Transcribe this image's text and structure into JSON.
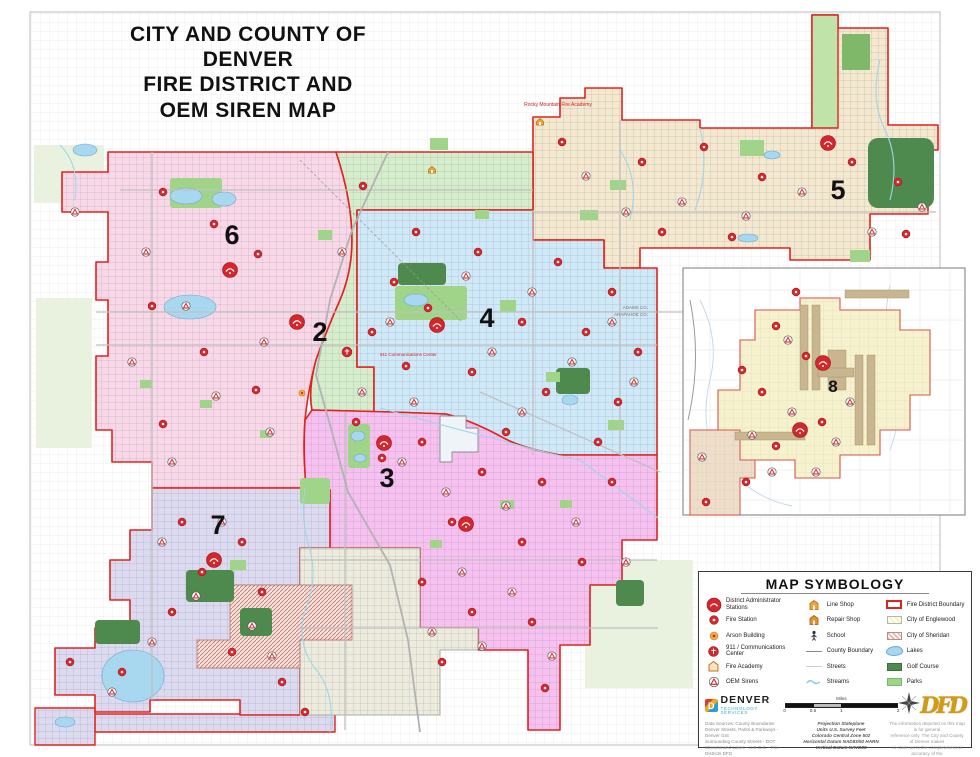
{
  "title": {
    "line1": "CITY AND COUNTY OF DENVER",
    "line2": "FIRE DISTRICT AND",
    "line3": "OEM SIREN MAP"
  },
  "districts": [
    {
      "number": "6",
      "color": "#f8d8e6"
    },
    {
      "number": "2",
      "color": "#d5edcb"
    },
    {
      "number": "4",
      "color": "#cfe9f7"
    },
    {
      "number": "5",
      "color": "#f4e8cf"
    },
    {
      "number": "3",
      "color": "#f6c0ef"
    },
    {
      "number": "7",
      "color": "#dcdaef"
    },
    {
      "number": "8",
      "color": "#f6f2cd"
    }
  ],
  "map_labels": {
    "fire_academy": "Rocky Mountain Fire Academy",
    "comm_center": "911 Communications Center",
    "county_north": "ADAMS CO.",
    "county_south": "ARAPAHOE CO."
  },
  "legend": {
    "title": "MAP SYMBOLOGY",
    "col1": [
      {
        "icon": "district-admin-station-icon",
        "label": "District Administrator Stations"
      },
      {
        "icon": "fire-station-icon",
        "label": "Fire Station"
      },
      {
        "icon": "arson-building-icon",
        "label": "Arson Building"
      },
      {
        "icon": "911-communications-icon",
        "label": "911 / Communications Center"
      },
      {
        "icon": "fire-academy-icon",
        "label": "Fire Academy"
      },
      {
        "icon": "oem-siren-icon",
        "label": "OEM Sirens"
      }
    ],
    "col2": [
      {
        "icon": "line-shop-icon",
        "label": "Line Shop"
      },
      {
        "icon": "repair-shop-icon",
        "label": "Repair Shop"
      },
      {
        "icon": "school-icon",
        "label": "School"
      },
      {
        "icon": "county-boundary-icon",
        "label": "County Boundary"
      },
      {
        "icon": "streets-icon",
        "label": "Streets"
      },
      {
        "icon": "streams-icon",
        "label": "Streams"
      }
    ],
    "col3": [
      {
        "icon": "fire-district-boundary-swatch",
        "label": "Fire District Boundary"
      },
      {
        "icon": "englewood-swatch",
        "label": "City of Englewood"
      },
      {
        "icon": "sheridan-swatch",
        "label": "City of Sheridan"
      },
      {
        "icon": "lakes-swatch",
        "label": "Lakes"
      },
      {
        "icon": "golf-course-swatch",
        "label": "Golf Course"
      },
      {
        "icon": "parks-swatch",
        "label": "Parks"
      }
    ]
  },
  "footer": {
    "denver_logo_title": "DENVER",
    "denver_logo_subtitle": "TECHNOLOGY SERVICES",
    "denver_logo_letter": "D",
    "dfd_logo": "DFD",
    "scale": {
      "unit": "Miles",
      "labels": [
        "0",
        "0.5",
        "1",
        "2"
      ]
    },
    "data_sources": [
      "Data Sources: County Boundaries",
      "Denver Streets, Parks & Parkways - Denver GIS",
      "Surrounding County Streets - DOT",
      "Streams and Lakes - U.S.G.S. - Fire Districts DFD"
    ],
    "projection": [
      "Projection Stateplane",
      "Units U.S. Survey Feet",
      "Colorado Central Zone 502",
      "Horizontal Datum NAD83/92 HARN",
      "Vertical Datum NAVD88"
    ],
    "disclaimer": [
      "The information depicted on this map is for general",
      "reference only. The City and County of Denver makes",
      "no claim as to the completeness or accuracy of the",
      "data contained hereon."
    ],
    "map_prepared": "Map Prepared: January 10, 2003"
  },
  "map": {
    "boundary_color": "#e0231f",
    "icons": {
      "district_admin": [
        [
          230,
          270
        ],
        [
          297,
          322
        ],
        [
          437,
          325
        ],
        [
          828,
          143
        ],
        [
          384,
          443
        ],
        [
          466,
          524
        ],
        [
          214,
          560
        ],
        [
          823,
          363
        ],
        [
          800,
          430
        ]
      ],
      "fire_station": [
        [
          163,
          192
        ],
        [
          214,
          224
        ],
        [
          258,
          254
        ],
        [
          152,
          306
        ],
        [
          204,
          352
        ],
        [
          256,
          390
        ],
        [
          163,
          424
        ],
        [
          363,
          186
        ],
        [
          416,
          232
        ],
        [
          394,
          282
        ],
        [
          428,
          308
        ],
        [
          372,
          332
        ],
        [
          406,
          366
        ],
        [
          356,
          422
        ],
        [
          382,
          458
        ],
        [
          478,
          252
        ],
        [
          558,
          262
        ],
        [
          612,
          292
        ],
        [
          522,
          322
        ],
        [
          586,
          332
        ],
        [
          638,
          352
        ],
        [
          472,
          372
        ],
        [
          546,
          392
        ],
        [
          618,
          402
        ],
        [
          506,
          432
        ],
        [
          598,
          442
        ],
        [
          562,
          142
        ],
        [
          642,
          162
        ],
        [
          704,
          147
        ],
        [
          762,
          177
        ],
        [
          852,
          162
        ],
        [
          898,
          182
        ],
        [
          662,
          232
        ],
        [
          732,
          237
        ],
        [
          906,
          234
        ],
        [
          422,
          442
        ],
        [
          482,
          472
        ],
        [
          542,
          482
        ],
        [
          612,
          482
        ],
        [
          452,
          522
        ],
        [
          522,
          542
        ],
        [
          582,
          562
        ],
        [
          422,
          582
        ],
        [
          472,
          612
        ],
        [
          532,
          622
        ],
        [
          442,
          662
        ],
        [
          545,
          688
        ],
        [
          182,
          522
        ],
        [
          242,
          542
        ],
        [
          202,
          572
        ],
        [
          262,
          592
        ],
        [
          172,
          612
        ],
        [
          232,
          652
        ],
        [
          282,
          682
        ],
        [
          122,
          672
        ],
        [
          70,
          662
        ],
        [
          305,
          712
        ],
        [
          796,
          292
        ],
        [
          776,
          326
        ],
        [
          806,
          356
        ],
        [
          762,
          392
        ],
        [
          822,
          422
        ],
        [
          776,
          446
        ],
        [
          746,
          482
        ],
        [
          706,
          502
        ],
        [
          742,
          370
        ]
      ],
      "oem_siren": [
        [
          146,
          252
        ],
        [
          186,
          306
        ],
        [
          264,
          342
        ],
        [
          216,
          396
        ],
        [
          132,
          362
        ],
        [
          270,
          432
        ],
        [
          172,
          462
        ],
        [
          342,
          252
        ],
        [
          390,
          322
        ],
        [
          414,
          402
        ],
        [
          362,
          392
        ],
        [
          466,
          276
        ],
        [
          532,
          292
        ],
        [
          612,
          322
        ],
        [
          492,
          352
        ],
        [
          572,
          362
        ],
        [
          634,
          382
        ],
        [
          522,
          412
        ],
        [
          586,
          176
        ],
        [
          626,
          212
        ],
        [
          682,
          202
        ],
        [
          746,
          216
        ],
        [
          802,
          192
        ],
        [
          872,
          232
        ],
        [
          922,
          207
        ],
        [
          402,
          462
        ],
        [
          446,
          492
        ],
        [
          506,
          506
        ],
        [
          576,
          522
        ],
        [
          626,
          562
        ],
        [
          462,
          572
        ],
        [
          512,
          592
        ],
        [
          432,
          632
        ],
        [
          482,
          646
        ],
        [
          552,
          656
        ],
        [
          162,
          542
        ],
        [
          222,
          522
        ],
        [
          196,
          596
        ],
        [
          252,
          626
        ],
        [
          152,
          642
        ],
        [
          272,
          656
        ],
        [
          112,
          692
        ],
        [
          75,
          212
        ],
        [
          850,
          402
        ],
        [
          792,
          412
        ],
        [
          836,
          442
        ],
        [
          772,
          472
        ],
        [
          816,
          472
        ],
        [
          702,
          457
        ],
        [
          752,
          435
        ],
        [
          788,
          340
        ]
      ],
      "arson": [
        [
          302,
          393
        ]
      ],
      "shop": [
        [
          432,
          170
        ],
        [
          540,
          122
        ]
      ],
      "comm911": [
        [
          347,
          352
        ]
      ]
    }
  }
}
